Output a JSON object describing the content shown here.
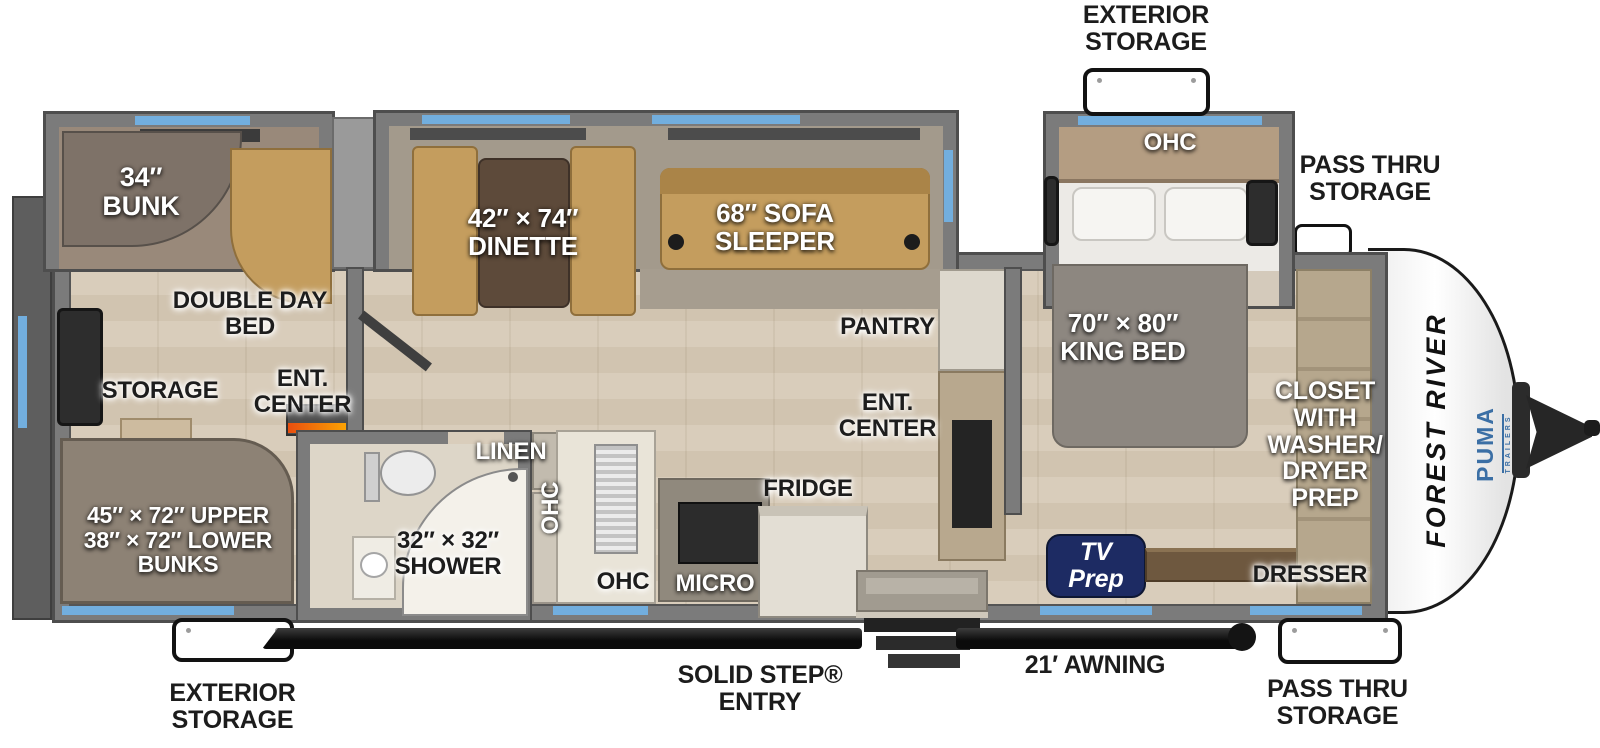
{
  "brand": {
    "maker": "FOREST RIVER",
    "model": "PUMA",
    "model_sub": "TRAILERS"
  },
  "exterior_labels": {
    "top_storage": "EXTERIOR\nSTORAGE",
    "top_pass_thru": "PASS THRU\nSTORAGE",
    "bottom_storage": "EXTERIOR\nSTORAGE",
    "entry": "SOLID STEP®\nENTRY",
    "awning": "21′ AWNING",
    "bottom_pass_thru": "PASS THRU\nSTORAGE"
  },
  "bunkroom": {
    "bunk": "34″\nBUNK",
    "double_day_bed": "DOUBLE DAY\nBED",
    "ent_center": "ENT.\nCENTER",
    "storage": "STORAGE",
    "bunks": "45″ × 72″ UPPER\n38″ × 72″ LOWER\nBUNKS"
  },
  "living": {
    "dinette": "42″ × 74″\nDINETTE",
    "sofa_sleeper": "68″ SOFA\nSLEEPER",
    "pantry": "PANTRY",
    "ent_center": "ENT.\nCENTER"
  },
  "kitchen": {
    "fridge": "FRIDGE",
    "micro": "MICRO",
    "ohc_wall": "OHC",
    "ohc_counter": "OHC"
  },
  "bath": {
    "linen": "LINEN",
    "shower": "32″ × 32″\nSHOWER"
  },
  "bedroom": {
    "ohc": "OHC",
    "king_bed": "70″ × 80″\nKING BED",
    "closet": "CLOSET\nWITH\nWASHER/\nDRYER\nPREP",
    "dresser": "DRESSER",
    "tv_prep": "TV\nPrep"
  },
  "colors": {
    "window_accent": "#72aede",
    "wall_gray": "#7b7b7b",
    "sofa_tan": "#c49d5e",
    "carpet": "#9b9184",
    "wood_floor": "#d5c9b7",
    "tv_prep_badge": "#1d2b63",
    "awning_black": "#151515",
    "puma_blue": "#3b6fa5"
  }
}
